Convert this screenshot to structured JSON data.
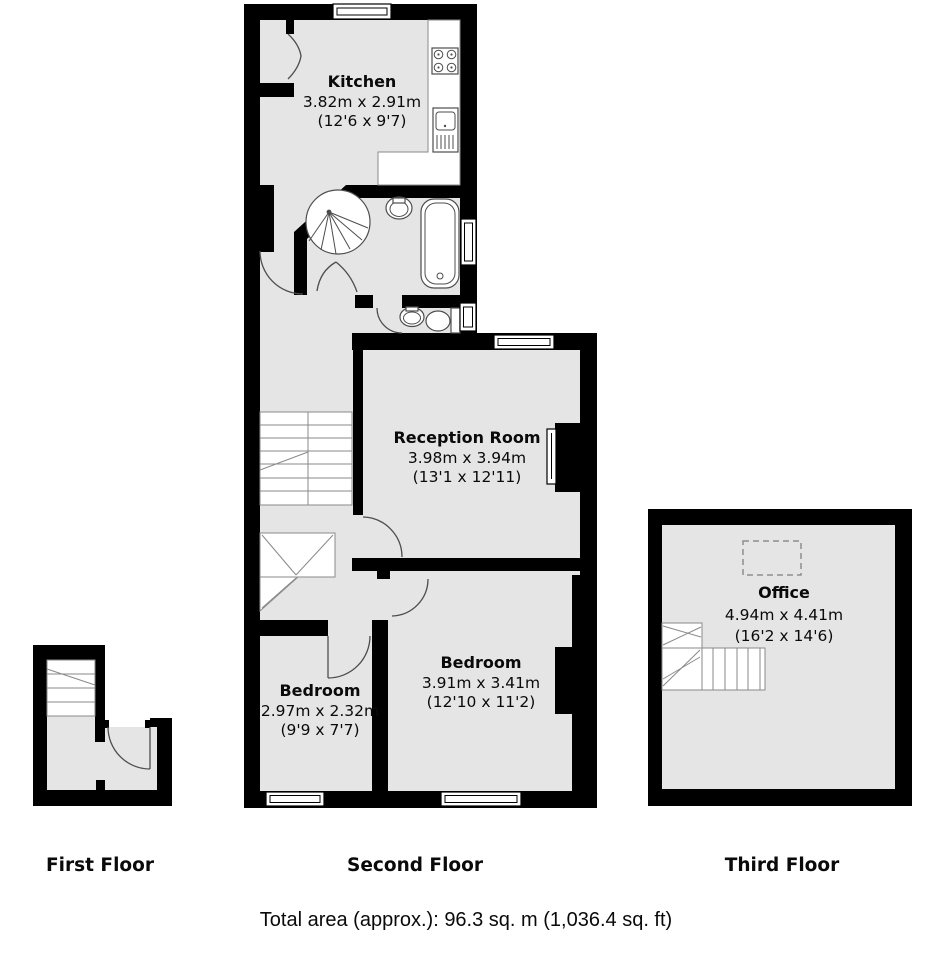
{
  "colors": {
    "wall": "#000000",
    "room_fill": "#e5e5e5",
    "stair_fill": "#ffffff",
    "fixture_line": "#4d4d4d",
    "stair_line": "#8a8a8a",
    "text": "#0a0a0a"
  },
  "floors": [
    {
      "label": "First Floor"
    },
    {
      "label": "Second Floor"
    },
    {
      "label": "Third Floor"
    }
  ],
  "rooms": [
    {
      "name": "Kitchen",
      "metric": "3.82m x 2.91m",
      "imperial": "(12'6 x 9'7)"
    },
    {
      "name": "Reception Room",
      "metric": "3.98m x 3.94m",
      "imperial": "(13'1 x 12'11)"
    },
    {
      "name": "Bedroom",
      "metric": "3.91m x 3.41m",
      "imperial": "(12'10 x 11'2)"
    },
    {
      "name": "Bedroom",
      "metric": "2.97m x 2.32m",
      "imperial": "(9'9 x 7'7)"
    },
    {
      "name": "Office",
      "metric": "4.94m x 4.41m",
      "imperial": "(16'2 x 14'6)"
    }
  ],
  "fixtures": [
    "hob",
    "kitchen-sink",
    "corner-shower",
    "washbasin",
    "bathtub",
    "toilet",
    "staircase",
    "roof-window"
  ],
  "footer": {
    "total_area": "Total area (approx.): 96.3 sq. m (1,036.4 sq. ft)"
  }
}
